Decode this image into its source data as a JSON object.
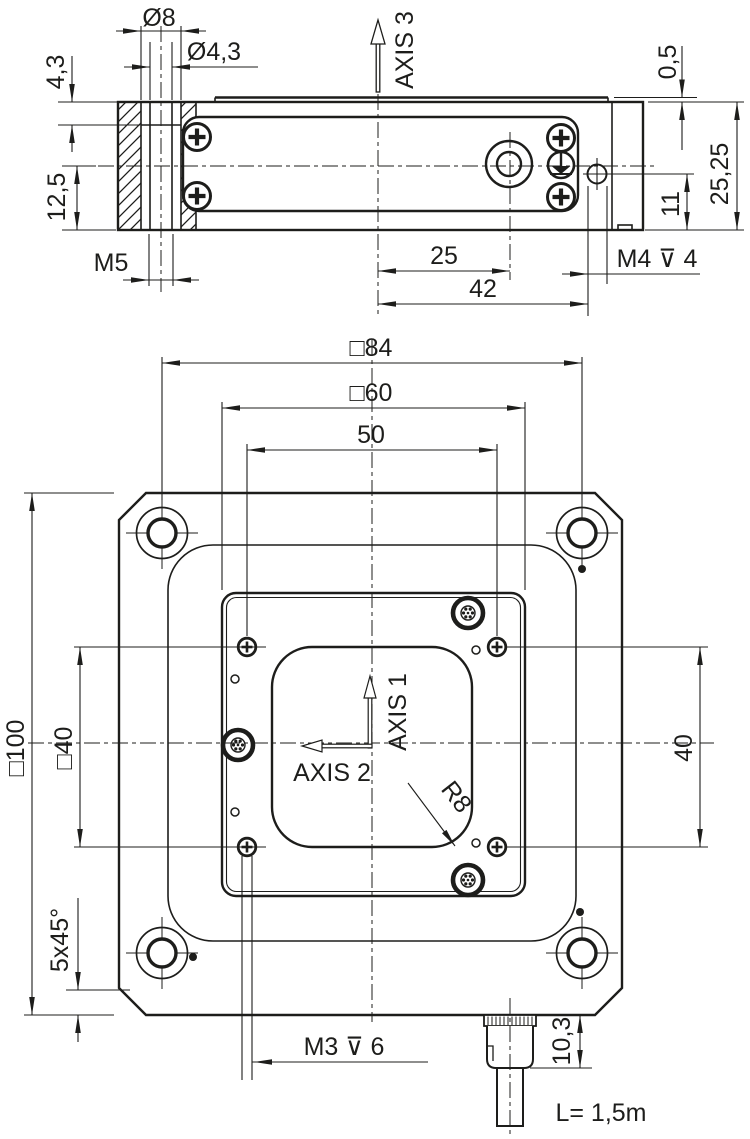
{
  "colors": {
    "line": "#1d1d1b",
    "background": "#ffffff"
  },
  "side": {
    "labels": {
      "dia8": "Ø8",
      "dia43": "Ø4,3",
      "depth43": "4,3",
      "h125": "12,5",
      "m5": "M5",
      "axis3": "AXIS 3",
      "step05": "0,5",
      "h2525": "25,25",
      "off11": "11",
      "m4": "M4 ⊽ 4",
      "d25": "25",
      "d42": "42"
    }
  },
  "plan": {
    "labels": {
      "sq84": "□84",
      "sq60": "□60",
      "d50": "50",
      "sq100": "□100",
      "sq40": "□40",
      "d40": "40",
      "axis1": "AXIS 1",
      "axis2": "AXIS 2",
      "r8": "R8",
      "chamfer": "5x45°",
      "m3": "M3 ⊽ 6",
      "h103": "10,3",
      "cable": "L= 1,5m"
    }
  }
}
